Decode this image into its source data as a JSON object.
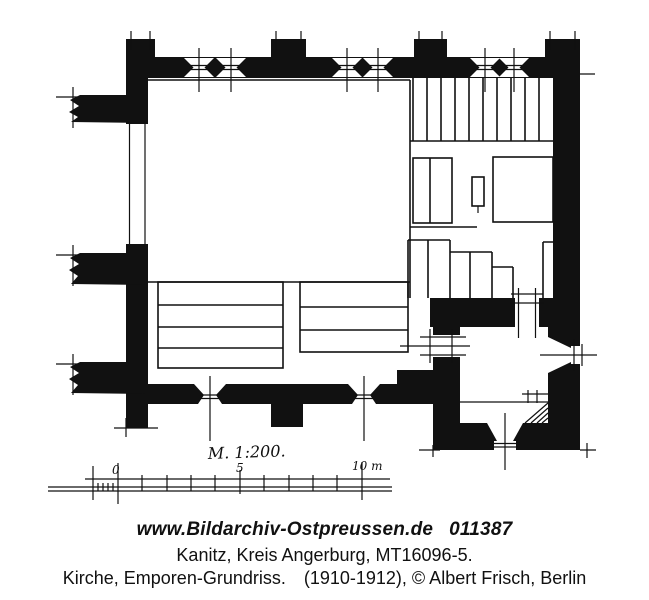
{
  "drawing": {
    "ink_color": "#111111",
    "paper_color": "#ffffff",
    "scale_bar": {
      "label": "M. 1:200.",
      "tick_zero": "0",
      "tick_five": "5",
      "tick_ten": "10 m"
    }
  },
  "caption": {
    "site": "www.Bildarchiv-Ostpreussen.de",
    "image_number": "011387",
    "location_line": "Kanitz, Kreis Angerburg, MT16096-5.",
    "subject_line": "Kirche, Emporen-Grundriss.",
    "credit_line": "(1910-1912), © Albert Frisch, Berlin"
  }
}
